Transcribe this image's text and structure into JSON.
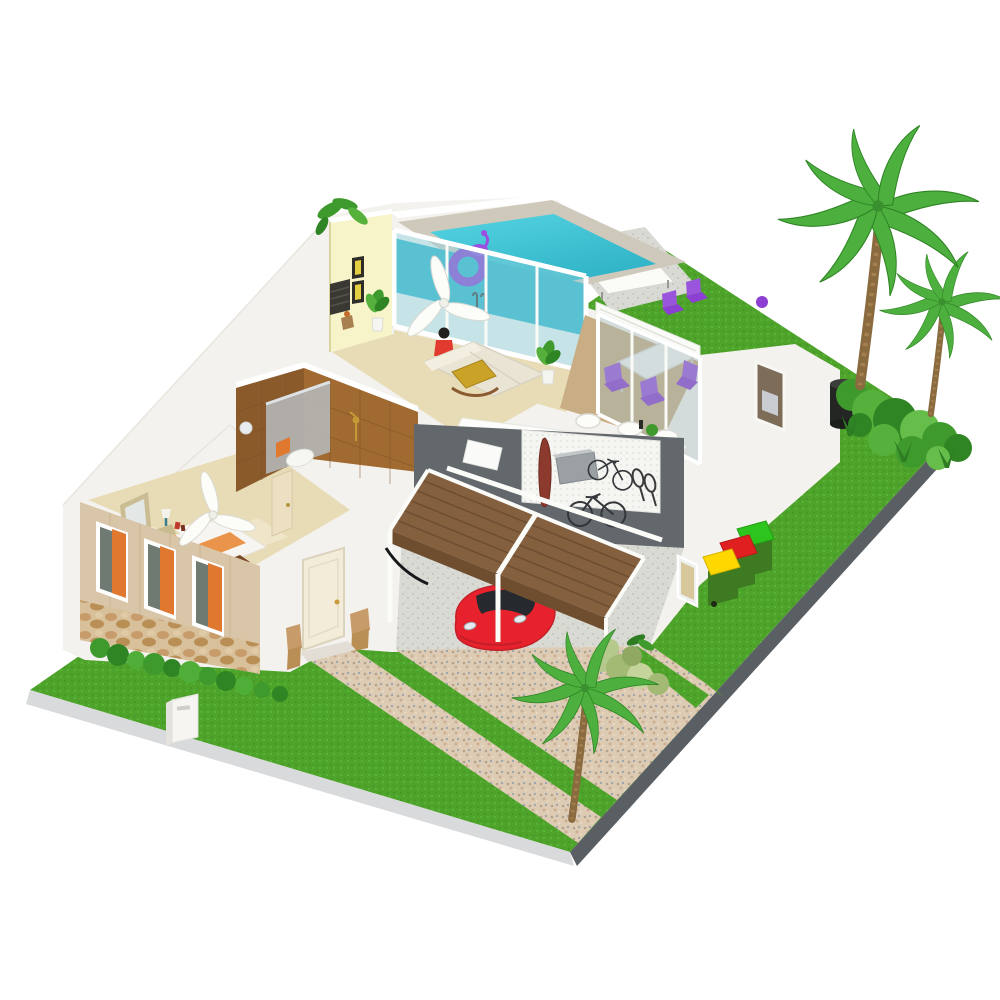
{
  "scene": {
    "description": "Isometric 3D cutaway rendering of a single-storey home with indoor pool, garage and tropical garden on a grass plot",
    "background": "#ffffff",
    "visible_text": "none"
  },
  "palette": {
    "grass": "#4ea32b",
    "plot_edge_light": "#d8dadb",
    "plot_edge_dark": "#5a5f63",
    "house_white": "#f4f2ee",
    "pool_deck": "#cfc9bc",
    "pool_water_deep": "#2fb2c6",
    "glass_tint": "#8fd2de",
    "yellow_wall": "#f8f4c9",
    "picture_yellow": "#e3cf3f",
    "bathroom_tile": "#8a5a2b",
    "bathroom_tile_light": "#a06a31",
    "shower_glass": "#b6bcc0",
    "gold_fixture": "#c59a36",
    "wood_floor": "#e8dcb6",
    "dining_floor": "#c9ae85",
    "deck_wood": "#85603f",
    "deck_fascia": "#6f4e30",
    "garage_wall": "#63686d",
    "surfboard": "#8d3a2e",
    "car_red": "#e8222d",
    "car_glass": "#26292d",
    "purple_chair": "#8c3fd2",
    "purple_chair_light": "#9a55dd",
    "mustard_chair": "#c9a227",
    "sofa_cream": "#eae4d4",
    "bed_orange": "#e8822e",
    "curtain_orange": "#e07830",
    "tan_wall": "#d9c6a8",
    "bin_body_green": "#3e7a22",
    "bin_lid_green": "#2ec41e",
    "bin_lid_red": "#e02020",
    "bin_lid_yellow": "#ffd800",
    "red_shirt": "#e23a2e"
  },
  "objects": {
    "rooms": [
      {
        "name": "pool-room",
        "features": [
          "indoor pool",
          "glass sliding walls",
          "purple swim ring",
          "purple flamingo float",
          "pool ladder",
          "ceiling fan"
        ]
      },
      {
        "name": "living-room",
        "features": [
          "yellow accent wall",
          "two framed pictures",
          "cream sofa",
          "mustard armchair",
          "person in red top",
          "potted plants"
        ]
      },
      {
        "name": "kitchen",
        "features": [
          "white breakfast counter",
          "three white stools",
          "counter plants"
        ]
      },
      {
        "name": "dining-room",
        "features": [
          "white table",
          "purple chairs",
          "glass sliding doors",
          "wood floor"
        ]
      },
      {
        "name": "bathroom",
        "features": [
          "brown tiled walls",
          "glass shower screen",
          "gold shower fixture",
          "orange towel",
          "round mirror"
        ]
      },
      {
        "name": "bedroom",
        "features": [
          "bed with orange bedding",
          "leaning mirror",
          "bedside lamp",
          "ceiling fan",
          "three windows with orange curtains",
          "stone wainscot facade"
        ]
      },
      {
        "name": "garage",
        "features": [
          "red sports car",
          "wood roof deck with white railing",
          "white pegboard wall",
          "surfboard",
          "two bicycles",
          "tennis rackets",
          "wall cabinet",
          "speckled concrete floor"
        ]
      },
      {
        "name": "laundry-nook",
        "features": [
          "narrow window"
        ]
      }
    ],
    "exterior": [
      {
        "name": "lawn",
        "count": 1
      },
      {
        "name": "roof-terrace-loungers",
        "count": 2
      },
      {
        "name": "outdoor-dining-chairs",
        "count": 2
      },
      {
        "name": "wheelie-bins",
        "count": 3,
        "lid_colors": [
          "green",
          "red",
          "yellow"
        ]
      },
      {
        "name": "palm-trees",
        "count": 3
      },
      {
        "name": "shrub-clusters",
        "count": 4
      },
      {
        "name": "rain-barrel",
        "count": 1
      },
      {
        "name": "gravel-driveway",
        "count": 1
      },
      {
        "name": "front-walkway",
        "count": 1
      },
      {
        "name": "mailbox",
        "count": 1
      }
    ]
  }
}
